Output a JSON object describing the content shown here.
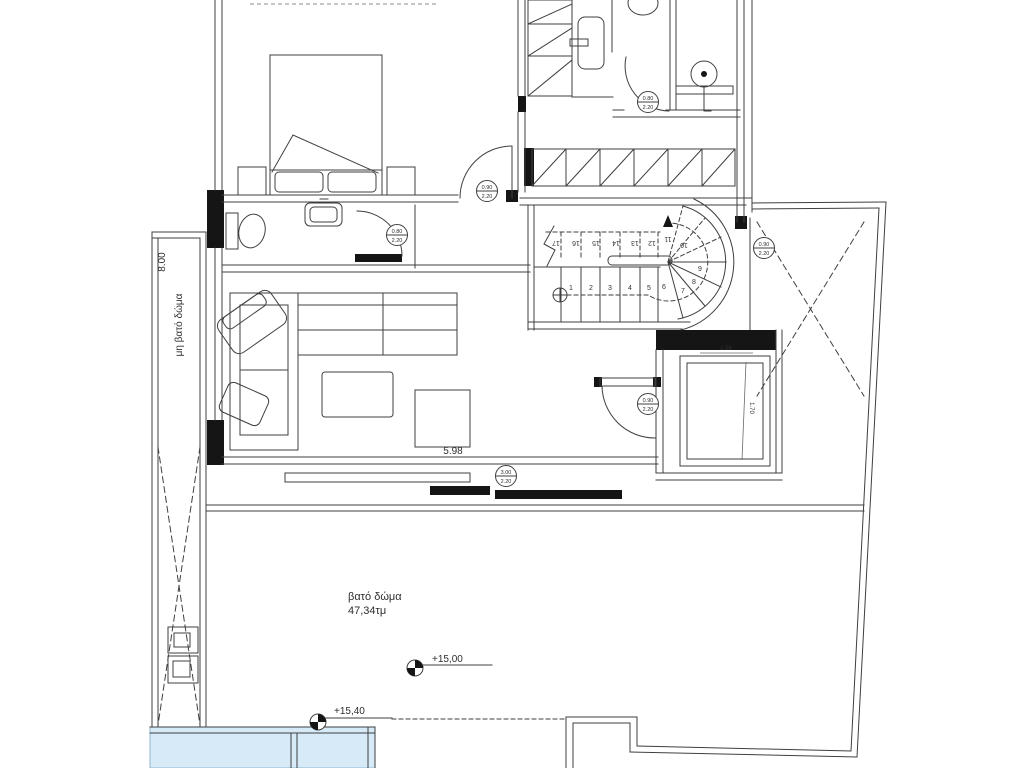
{
  "labels": {
    "left_dim": "8.00",
    "left_strip": "μη βατό δώμα",
    "terrace_name": "βατό δώμα",
    "terrace_area": "47,34τμ",
    "level_upper": "+15,00",
    "level_lower": "+15,40",
    "living_dim": "5.98",
    "elev_width": "1.56",
    "elev_depth": "1.70"
  },
  "door_tags": {
    "wc": {
      "w": "0.80",
      "h": "2.20"
    },
    "bedroom": {
      "w": "0.90",
      "h": "2.20"
    },
    "bath": {
      "w": "0.80",
      "h": "2.20"
    },
    "lobby": {
      "w": "0.90",
      "h": "2.20"
    },
    "terrace": {
      "w": "0.90",
      "h": "2.20"
    },
    "slider": {
      "w": "3.00",
      "h": "2.20"
    }
  },
  "stairs": {
    "lower": [
      "1",
      "2",
      "3",
      "4",
      "5",
      "6",
      "7",
      "8",
      "9"
    ],
    "upper": [
      "17",
      "16",
      "15",
      "14",
      "13",
      "12",
      "11",
      "10"
    ]
  },
  "colors": {
    "pool": "#d6eaf8",
    "pool_edge": "#8fb8d0"
  }
}
